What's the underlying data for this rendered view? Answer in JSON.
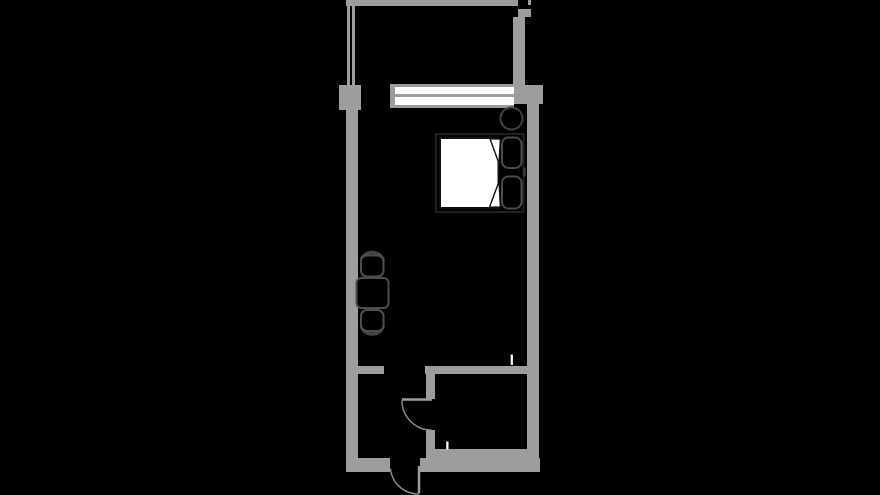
{
  "page": {
    "width": 880,
    "height": 495,
    "kind": "floor-plan drawing, dark background"
  },
  "colors": {
    "bg": "#000000",
    "wall": "#9d9d9d",
    "door_line": "#8f8f8f",
    "glass": "#ffffff",
    "mattress": "#ffffff",
    "bed_frame": "#202020",
    "dark_outline": "#121212",
    "furniture_outline": "#4d4d4d",
    "seat_outline": "#4f4f4f",
    "back_outline": "#454545",
    "pillow_outline": "#4a4a4a",
    "stool_outline": "#414141",
    "tick_white": "#ffffff"
  },
  "floor_plan": {
    "areas": [
      "balcony",
      "main-room",
      "vestibule",
      "bathroom"
    ],
    "structure": [
      "balcony-railing-top",
      "balcony-railing-left-double-line",
      "balcony-right-wall",
      "left-pilaster",
      "left-wall",
      "right-pier",
      "right-wall",
      "bottom-wall-left",
      "bottom-wall-right",
      "bathroom-top-wall",
      "vestibule-stub-wall",
      "bathroom-partition-upper",
      "bathroom-partition-lower",
      "bathroom-floor-wall"
    ],
    "openings": [
      "window-two-panes",
      "balcony-opening",
      "room-to-vestibule-passage",
      "bathroom-door-with-swing-arc",
      "entrance-door-with-swing-arc"
    ],
    "furniture": [
      "stool-circle",
      "double-bed",
      "mattress-with-folded-duvet-corners",
      "pillow-top",
      "pillow-bottom",
      "square-table",
      "chair-top",
      "chair-bottom"
    ],
    "markers": [
      "white-tick-at-bathroom-top-wall",
      "white-tick-at-bathroom-floor-wall"
    ]
  }
}
